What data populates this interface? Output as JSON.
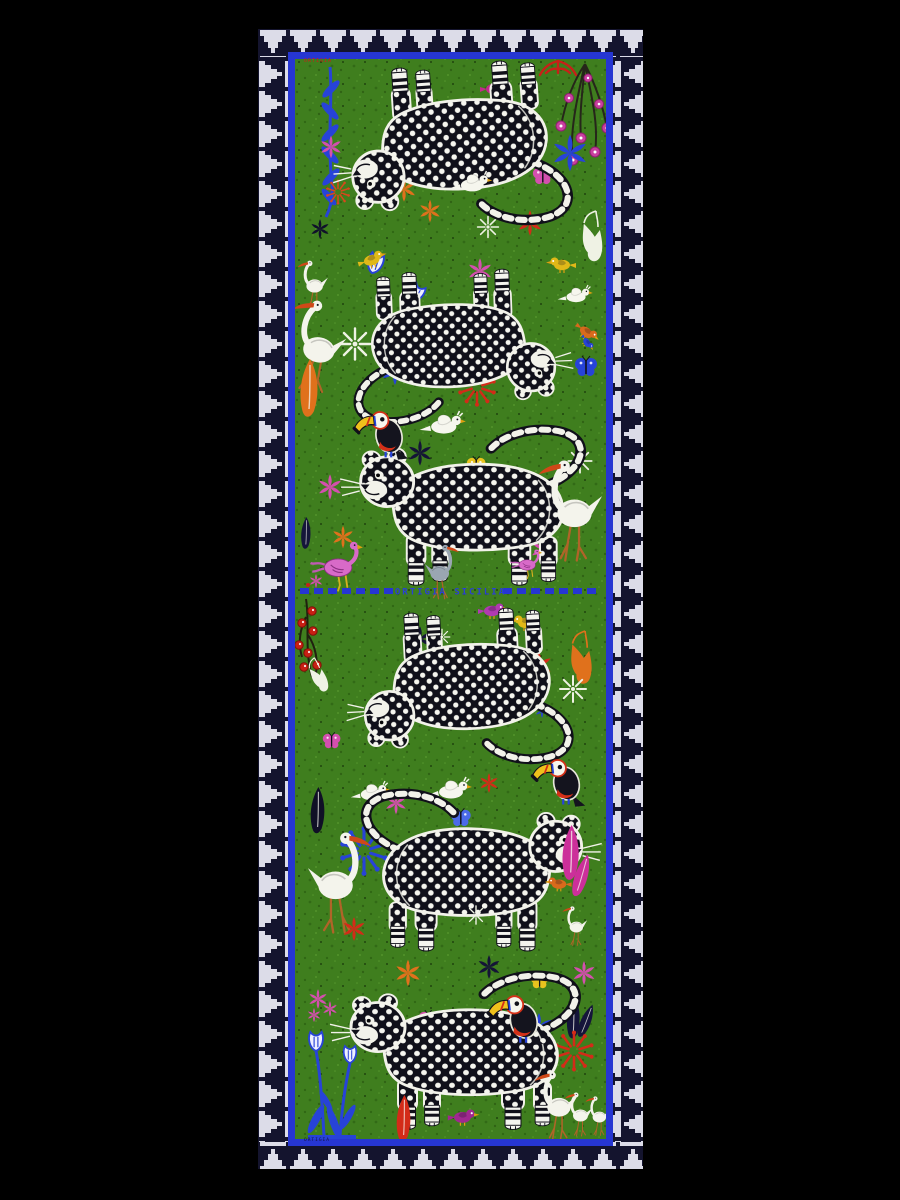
{
  "scene": {
    "description": "Flat-lay product photo of a long rectangular printed silk scarf on a black background",
    "background_color": "#000000"
  },
  "scarf": {
    "texts": {
      "center_label": "ORTIGIA SICILIA",
      "top_corner_label": "ORTIGIA",
      "bottom_corner_label": "ORTIGIA"
    },
    "palette": {
      "field_green": "#3f7e1e",
      "border_navy": "#14142e",
      "border_pattern_white": "#dcdce8",
      "frame_blue": "#2636d2",
      "leopard_black": "#10101a",
      "leopard_spot_white": "#f5f5ee",
      "accent_red": "#d32b18",
      "accent_orange": "#e0711c",
      "accent_pink": "#d44fae",
      "accent_magenta": "#c22c8c",
      "accent_blue": "#2743d8",
      "accent_yellow": "#e8c31e",
      "bird_white": "#f4f4ec"
    },
    "motif_inventory": [
      "polka-dot leopard x6 (two panels mirrored at center seam)",
      "toucan x3 perched on leopards",
      "white egret / ibis x8",
      "white cockatoo-dove x4",
      "pink flamingo-bird x2",
      "small songbirds (yellow, magenta, orange, purple)",
      "butterflies and moths (blue, pink, yellow)",
      "star, snowflake and firework blossoms (red, orange, pink, blue, white, navy)",
      "hanging blue branch, blue tulip plant",
      "pink blossom branch, red berry branch, orange plume, pear-shaped leaves",
      "white stepped-pyramid embroidered border on navy",
      "royal blue frame line and dashed center seam"
    ]
  }
}
